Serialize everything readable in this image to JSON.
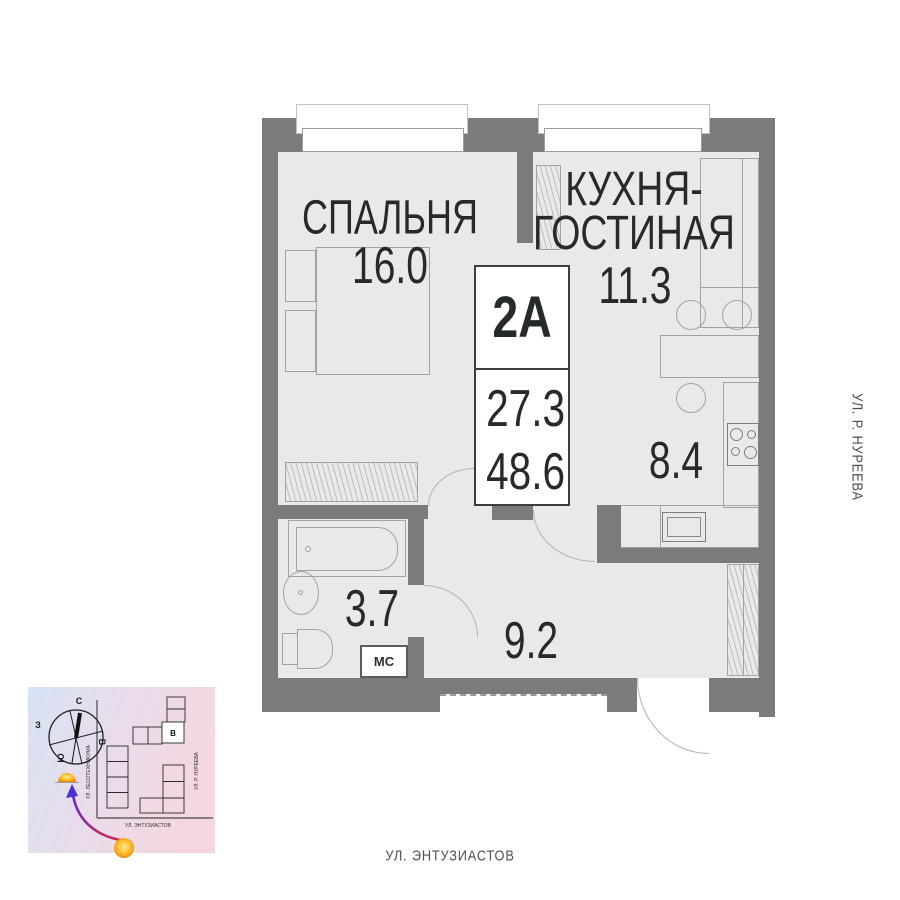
{
  "unit_card": {
    "unit": "2А",
    "living_area": "27.3",
    "total_area": "48.6"
  },
  "rooms": {
    "bedroom": {
      "name": "СПАЛЬНЯ",
      "area": "16.0"
    },
    "kitchen_living": {
      "name": "КУХНЯ-ГОСТИНАЯ",
      "area": "11.3"
    },
    "kitchen_zone": {
      "area": "8.4"
    },
    "bathroom": {
      "area": "3.7",
      "washer_label": "МС"
    },
    "hallway": {
      "area": "9.2"
    }
  },
  "streets": {
    "right": "УЛ. Р. НУРЕЕВА",
    "bottom": "УЛ. ЭНТУЗИАСТОВ"
  },
  "minimap": {
    "compass": {
      "north": "С",
      "south": "Ю",
      "west": "З",
      "east": "В"
    },
    "streets": {
      "vertical": "УЛ. ЛЕСОТЕХНИКУМА",
      "bottom": "УЛ. ЭНТУЗИАСТОВ",
      "right": "УЛ. Р. НУРЕЕВА"
    },
    "building_label": "В"
  },
  "colors": {
    "wall": "#7b7b7b",
    "floor": "#e9e9e9",
    "text": "#262b29",
    "sun": "#f59e00"
  }
}
